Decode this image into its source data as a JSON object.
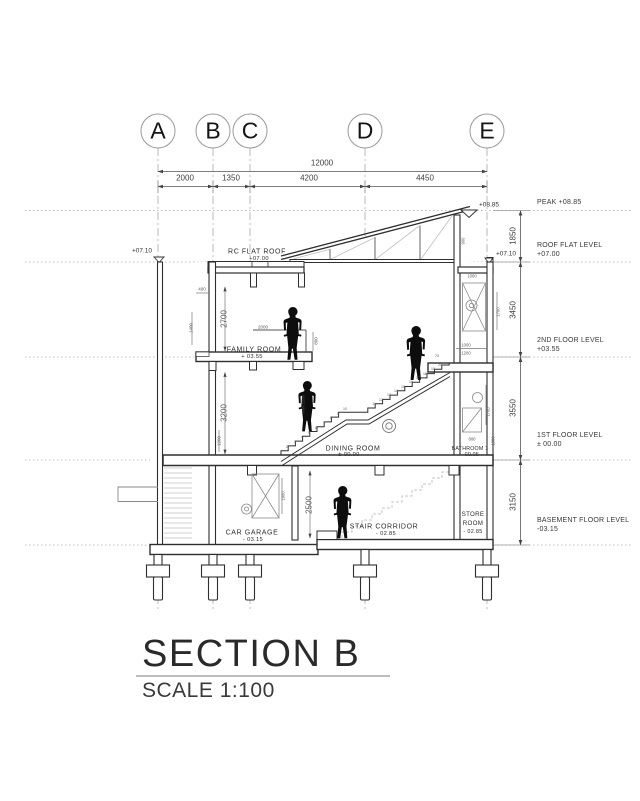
{
  "title": {
    "name": "SECTION B",
    "scale": "SCALE 1:100"
  },
  "grid": {
    "letters": [
      "A",
      "B",
      "C",
      "D",
      "E"
    ]
  },
  "dimensions": {
    "overall": "12000",
    "bays": [
      "2000",
      "1350",
      "4200",
      "4450"
    ],
    "heights": [
      "1850",
      "3450",
      "3550",
      "3150"
    ]
  },
  "levels": [
    {
      "label": "PEAK +08.85"
    },
    {
      "label": "ROOF FLAT LEVEL",
      "value": "+07.00"
    },
    {
      "label": "2ND FLOOR LEVEL",
      "value": "+03.55"
    },
    {
      "label": "1ST FLOOR LEVEL",
      "value": "± 00.00"
    },
    {
      "label": "BASEMENT FLOOR LEVEL",
      "value": "-03.15"
    }
  ],
  "markers": {
    "peak": "+08.85",
    "roof_left": "+07.10",
    "roof_right": "+07.10"
  },
  "rooms": [
    {
      "label": "RC FLAT ROOF",
      "value": "+07.00"
    },
    {
      "label": "FAMILY ROOM",
      "value": "+ 03.55"
    },
    {
      "label": "DINING ROOM",
      "value": "± 00.00"
    },
    {
      "label": "BATHROOM 1",
      "value": "- 00.05"
    },
    {
      "label": "CAR GARAGE",
      "value": "- 03.15"
    },
    {
      "label": "STAIR CORRIDOR",
      "value": "- 02.85"
    },
    {
      "label": "STORE ROOM",
      "value": "- 02.85"
    }
  ],
  "palette": {
    "line": "#2f2f2f",
    "dim": "#777777",
    "light": "#c9c9c9",
    "figure": "#0d0d0d",
    "background": "#ffffff"
  },
  "annotations": [
    {
      "n": "dim-2700",
      "t": "2700",
      "x": 224,
      "y": 319,
      "r": -90,
      "s": 8
    },
    {
      "n": "dim-3200",
      "t": "3200",
      "x": 224,
      "y": 413,
      "r": -90,
      "s": 8
    },
    {
      "n": "dim-2500",
      "t": "2500",
      "x": 309,
      "y": 505,
      "r": -90,
      "s": 8
    },
    {
      "n": "dim-1400",
      "t": "1400",
      "x": 191,
      "y": 328,
      "r": -90,
      "s": 4.5
    },
    {
      "n": "dim-400",
      "t": "400",
      "x": 202,
      "y": 289,
      "s": 4.5
    },
    {
      "n": "dim-2000-railing",
      "t": "2000",
      "x": 263,
      "y": 327,
      "s": 4.5
    },
    {
      "n": "dim-800-railing",
      "t": "800",
      "x": 316,
      "y": 341,
      "r": -90,
      "s": 4.5
    },
    {
      "n": "dim-1200-wall",
      "t": "1200",
      "x": 219,
      "y": 441,
      "r": -90,
      "s": 4.5
    },
    {
      "n": "dim-900-roof",
      "t": "900",
      "x": 463,
      "y": 241,
      "r": -90,
      "s": 4.2
    },
    {
      "n": "dim-1000-shaft",
      "t": "1000",
      "x": 472,
      "y": 276,
      "s": 4.2
    },
    {
      "n": "dim-1700-shaft",
      "t": "1700",
      "x": 498,
      "y": 312,
      "r": -90,
      "s": 4.2
    },
    {
      "n": "dim-1000-landing",
      "t": "1000",
      "x": 466,
      "y": 345,
      "s": 4.2
    },
    {
      "n": "dim-1200-landing",
      "t": "1200",
      "x": 466,
      "y": 353,
      "s": 4.2
    },
    {
      "n": "dim-70-landing",
      "t": "70",
      "x": 437,
      "y": 356,
      "s": 3.8
    },
    {
      "n": "dim-1700-bath",
      "t": "1700",
      "x": 488,
      "y": 412,
      "r": -90,
      "s": 4.2
    },
    {
      "n": "dim-800-bath",
      "t": "800",
      "x": 472,
      "y": 439,
      "s": 4.2
    },
    {
      "n": "dim-1000-bath",
      "t": "1000",
      "x": 493,
      "y": 441,
      "r": -90,
      "s": 4.2
    },
    {
      "n": "dim-1900-garage",
      "t": "1900",
      "x": 283,
      "y": 496,
      "r": -90,
      "s": 4.2
    },
    {
      "n": "min-headroom",
      "t": "MIN 2200",
      "x": 303,
      "y": 404,
      "r": -90,
      "s": 4
    },
    {
      "n": "stair-step-number",
      "t": "2",
      "x": 287,
      "y": 447,
      "s": 3.5
    },
    {
      "n": "stair-step-number",
      "t": "3",
      "x": 295,
      "y": 442,
      "s": 3.5
    },
    {
      "n": "stair-step-number",
      "t": "4",
      "x": 302,
      "y": 437,
      "s": 3.5
    },
    {
      "n": "stair-step-number",
      "t": "5",
      "x": 309,
      "y": 433,
      "s": 3.5
    },
    {
      "n": "stair-step-number",
      "t": "6",
      "x": 316,
      "y": 428,
      "s": 3.5
    },
    {
      "n": "stair-step-number",
      "t": "7",
      "x": 324,
      "y": 423,
      "s": 3.5
    },
    {
      "n": "stair-step-number",
      "t": "8",
      "x": 331,
      "y": 418,
      "s": 3.5
    },
    {
      "n": "stair-step-number",
      "t": "9",
      "x": 338,
      "y": 414,
      "s": 3.5
    },
    {
      "n": "stair-step-number",
      "t": "10",
      "x": 345,
      "y": 409,
      "s": 3.5
    },
    {
      "n": "stair-step-number",
      "t": "11",
      "x": 374,
      "y": 404,
      "s": 3.5
    },
    {
      "n": "stair-step-number",
      "t": "12",
      "x": 381,
      "y": 400,
      "s": 3.5
    },
    {
      "n": "stair-step-number",
      "t": "13",
      "x": 389,
      "y": 395,
      "s": 3.5
    },
    {
      "n": "stair-step-number",
      "t": "14",
      "x": 396,
      "y": 391,
      "s": 3.5
    },
    {
      "n": "stair-step-number",
      "t": "15",
      "x": 403,
      "y": 387,
      "s": 3.5
    },
    {
      "n": "stair-step-number",
      "t": "16",
      "x": 411,
      "y": 382,
      "s": 3.5
    },
    {
      "n": "stair-step-number",
      "t": "17",
      "x": 418,
      "y": 378,
      "s": 3.5
    },
    {
      "n": "stair-step-number",
      "t": "18",
      "x": 425,
      "y": 374,
      "s": 3.5
    },
    {
      "n": "stair-step-number",
      "t": "19",
      "x": 433,
      "y": 369,
      "s": 3.5
    },
    {
      "n": "stair-step-number",
      "t": "20",
      "x": 440,
      "y": 365,
      "s": 3.5
    }
  ]
}
